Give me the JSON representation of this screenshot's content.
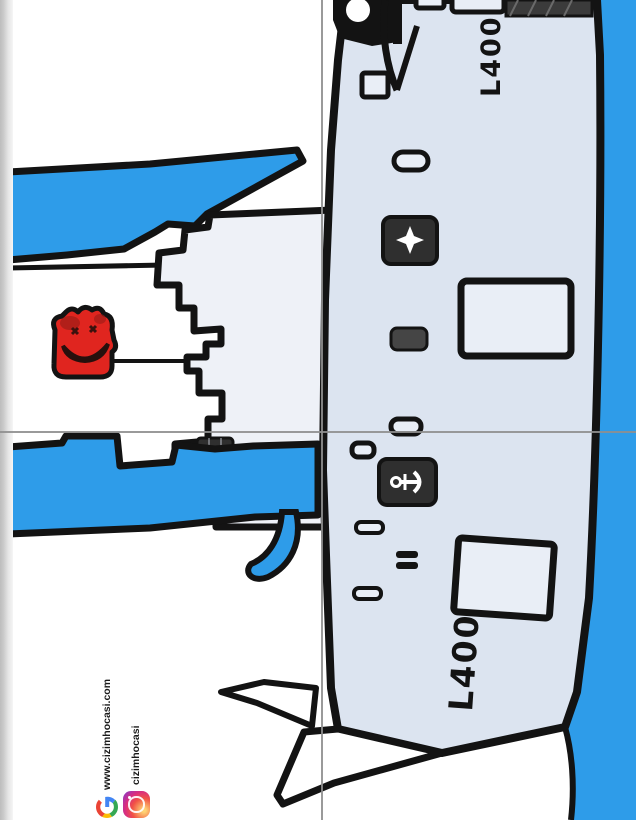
{
  "artwork": {
    "pennant_top": "L400",
    "pennant_bottom": "L400",
    "watermark": {
      "website": "www.cizimhocasi.com",
      "instagram_handle": "cizimhocasi"
    },
    "scene": {
      "subject": "cartoon amphibious assault ship with pennant number L400, castle tower with red mascot character, water, quarter-fold guide lines",
      "orientation": "drawing rotated 90 degrees on page"
    },
    "colors": {
      "water": "#2e9ce9",
      "hull": "#dce4f0",
      "hull_light": "#e9eef6",
      "castle": "#eef1f7",
      "outline": "#131313",
      "fixture_dark": "#2f2f2f",
      "fixture_mid": "#454545",
      "character_red": "#e0251f",
      "character_dark": "#a21d18",
      "fold_line": "#8f8f8f",
      "page_edge": "#c8c8c8",
      "text_dark": "#1a1a1a"
    }
  }
}
